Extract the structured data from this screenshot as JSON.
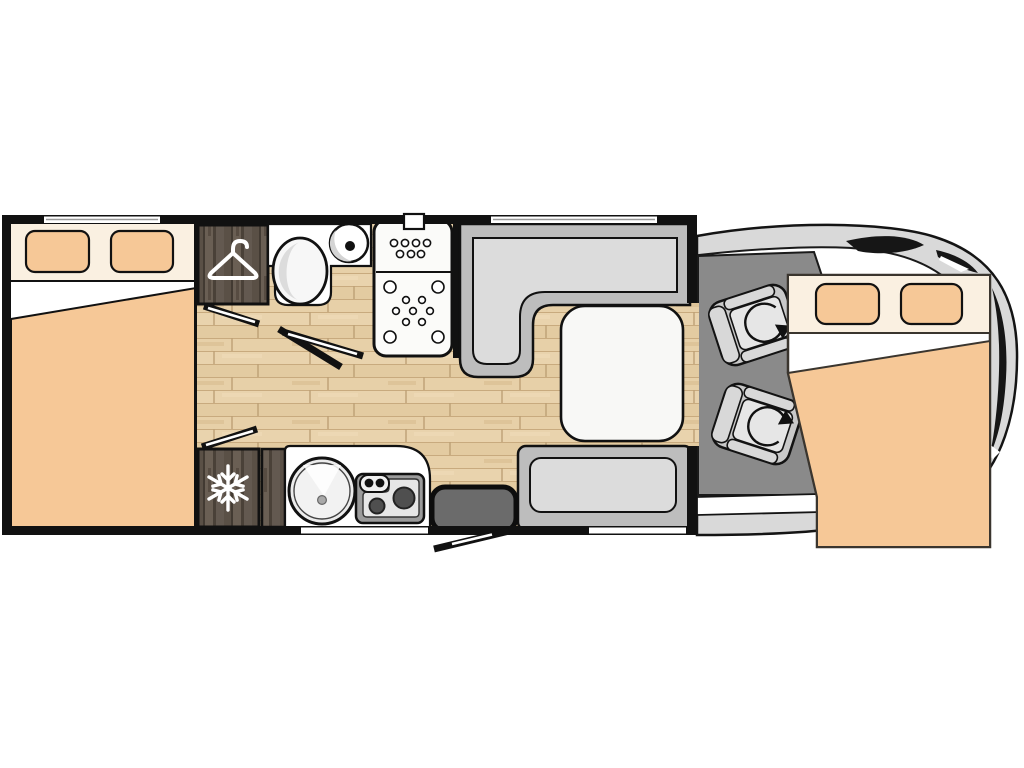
{
  "page": {
    "background": "#ffffff",
    "description": "Top-down floor plan of a motorhome with rear double bed, wardrobe, bathroom, shower, kitchen, fridge, L-shaped dinette with table, entry door, cab with two swivel seats and an over-cab double bed"
  },
  "colors": {
    "wall_black": "#111111",
    "wood_floor": "#e7d0a9",
    "wood_cabinet": "#574d44",
    "upholstery_peach": "#f6c897",
    "bed_cream": "#faf0e1",
    "plain_white": "#ffffff",
    "bench_gray": "#bdbdbd",
    "cushion_gray": "#dcdcdc",
    "cab_floor": "#8a8a8a",
    "seat_gray": "#c9c9c9",
    "body_outline_gray": "#d9d9d9",
    "step_gray": "#6b6b6b",
    "stove_gray": "#9b9b9b",
    "burner_dark": "#4f4f4f",
    "table_white": "#f8f8f6"
  },
  "floorplan": {
    "areas": {
      "rear_bedroom": "double bed with two pillows and folded duvet",
      "wardrobe": "tall wardrobe marked with clothes-hanger symbol",
      "bathroom": "toilet with round washbasin on counter",
      "shower": "shower tray with jet nozzles and wall outlet",
      "hallway": "wood floor corridor with two sliding door markers",
      "fridge": "refrigerator column marked with snowflake symbol",
      "kitchen": "counter with round sink and two-burner hob",
      "dinette": "L-shaped bench, facing side bench and white table",
      "entrance": "entry step with outward-swinging door",
      "cab": "driver cab floor with two swivelling captain seats",
      "overcab_bed": "drop-down double bed above the cab"
    },
    "counts": {
      "beds": 2,
      "pillows": 4,
      "cab_seats": 2,
      "hob_burners": 2,
      "wall_windows_top": 2,
      "wall_openings_bottom": 2
    },
    "icons": [
      {
        "name": "hanger-icon",
        "meaning": "wardrobe"
      },
      {
        "name": "snowflake-icon",
        "meaning": "refrigerator"
      },
      {
        "name": "swivel-arrow-icon",
        "meaning": "rotating cab seat",
        "count": 2
      }
    ]
  }
}
